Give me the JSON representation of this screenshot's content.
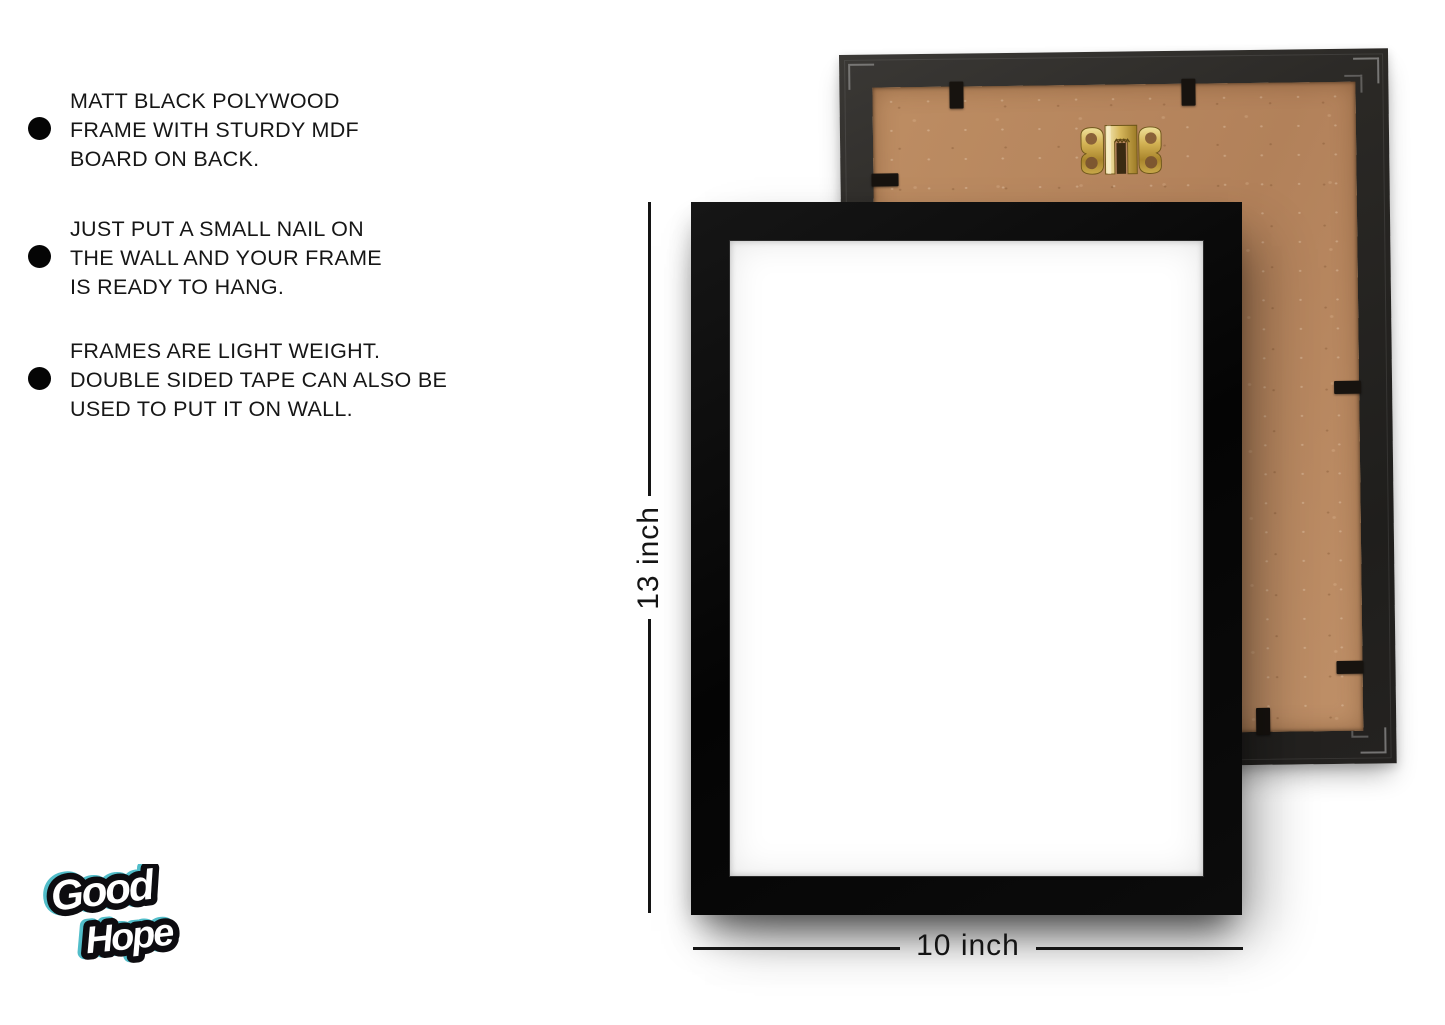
{
  "features": {
    "items": [
      {
        "lines": [
          "MATT BLACK POLYWOOD",
          "FRAME WITH STURDY MDF",
          "BOARD ON BACK."
        ]
      },
      {
        "lines": [
          "JUST PUT A SMALL NAIL ON",
          "THE WALL AND YOUR FRAME",
          "IS READY TO HANG."
        ]
      },
      {
        "lines": [
          "FRAMES ARE LIGHT WEIGHT.",
          "DOUBLE SIDED TAPE CAN ALSO BE",
          "USED TO PUT IT ON WALL."
        ]
      }
    ]
  },
  "dimensions": {
    "height_label": "13 inch",
    "width_label": "10 inch"
  },
  "brand": {
    "word1": "Good",
    "word2": "Hope"
  },
  "colors": {
    "front_frame_black": "#0a0a0a",
    "back_frame_dark": "#262420",
    "mdf_board_tan": "#b9895f",
    "hanger_gold": "#c6a33f",
    "logo_accent_cyan": "#3fb6c4",
    "annotation_text": "#141414",
    "background": "#ffffff"
  }
}
